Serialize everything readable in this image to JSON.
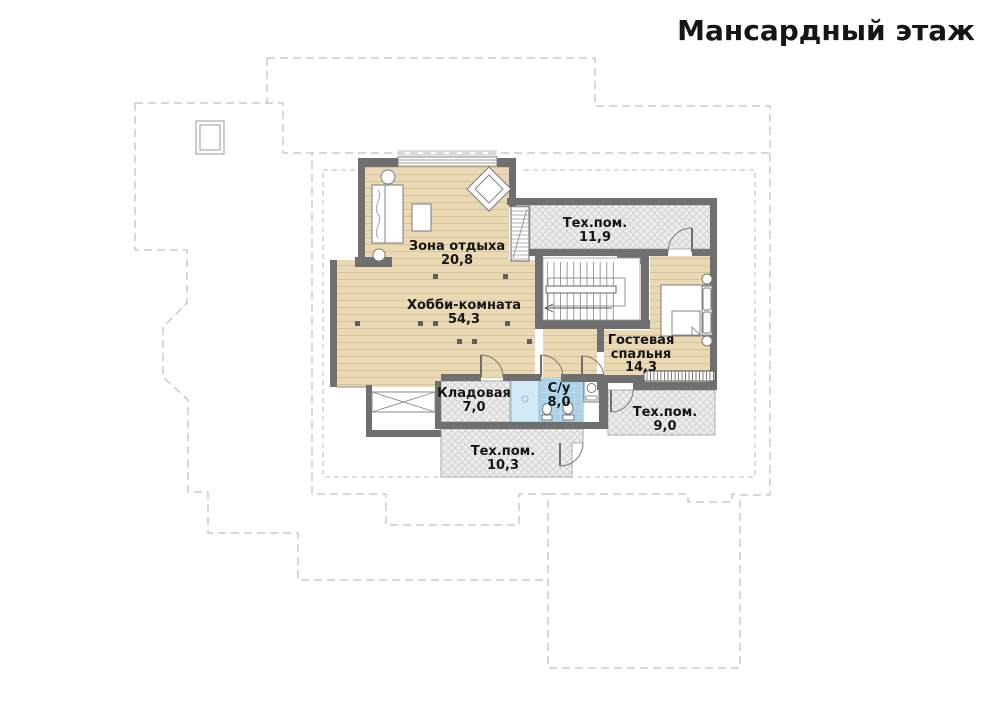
{
  "title": "Мансардный этаж",
  "plan": {
    "floor_name": "Мансардный этаж",
    "rooms": [
      {
        "name": "Зона отдыха",
        "area": "20,8"
      },
      {
        "name": "Хобби-комната",
        "area": "54,3"
      },
      {
        "name": "Тех.пом.",
        "area": "11,9"
      },
      {
        "name": "Гостевая",
        "name2": "спальня",
        "area": "14,3"
      },
      {
        "name": "Кладовая",
        "area": "7,0"
      },
      {
        "name": "С/у",
        "area": "8,0"
      },
      {
        "name": "Тех.пом.",
        "area": "9,0"
      },
      {
        "name": "Тех.пом.",
        "area": "10,3"
      }
    ],
    "icons": [
      "bed-icon",
      "armchair-icon",
      "stairs-icon",
      "toilet-icon",
      "shower-icon",
      "washer-icon",
      "wardrobe-icon",
      "chimney-icon"
    ],
    "colors": {
      "wood_floor": "#ead9b4",
      "wood_line": "#d6c499",
      "hatch_background": "#ededed",
      "hatch_line": "#d2d2d2",
      "tile_blue": "#a9d2e8",
      "tile_line": "#c9e4f4",
      "shower_blue": "#d3e9f6",
      "wall_gray": "#6f6f6f",
      "dash_gray": "#b2b2b2",
      "text_black": "#151515"
    }
  }
}
